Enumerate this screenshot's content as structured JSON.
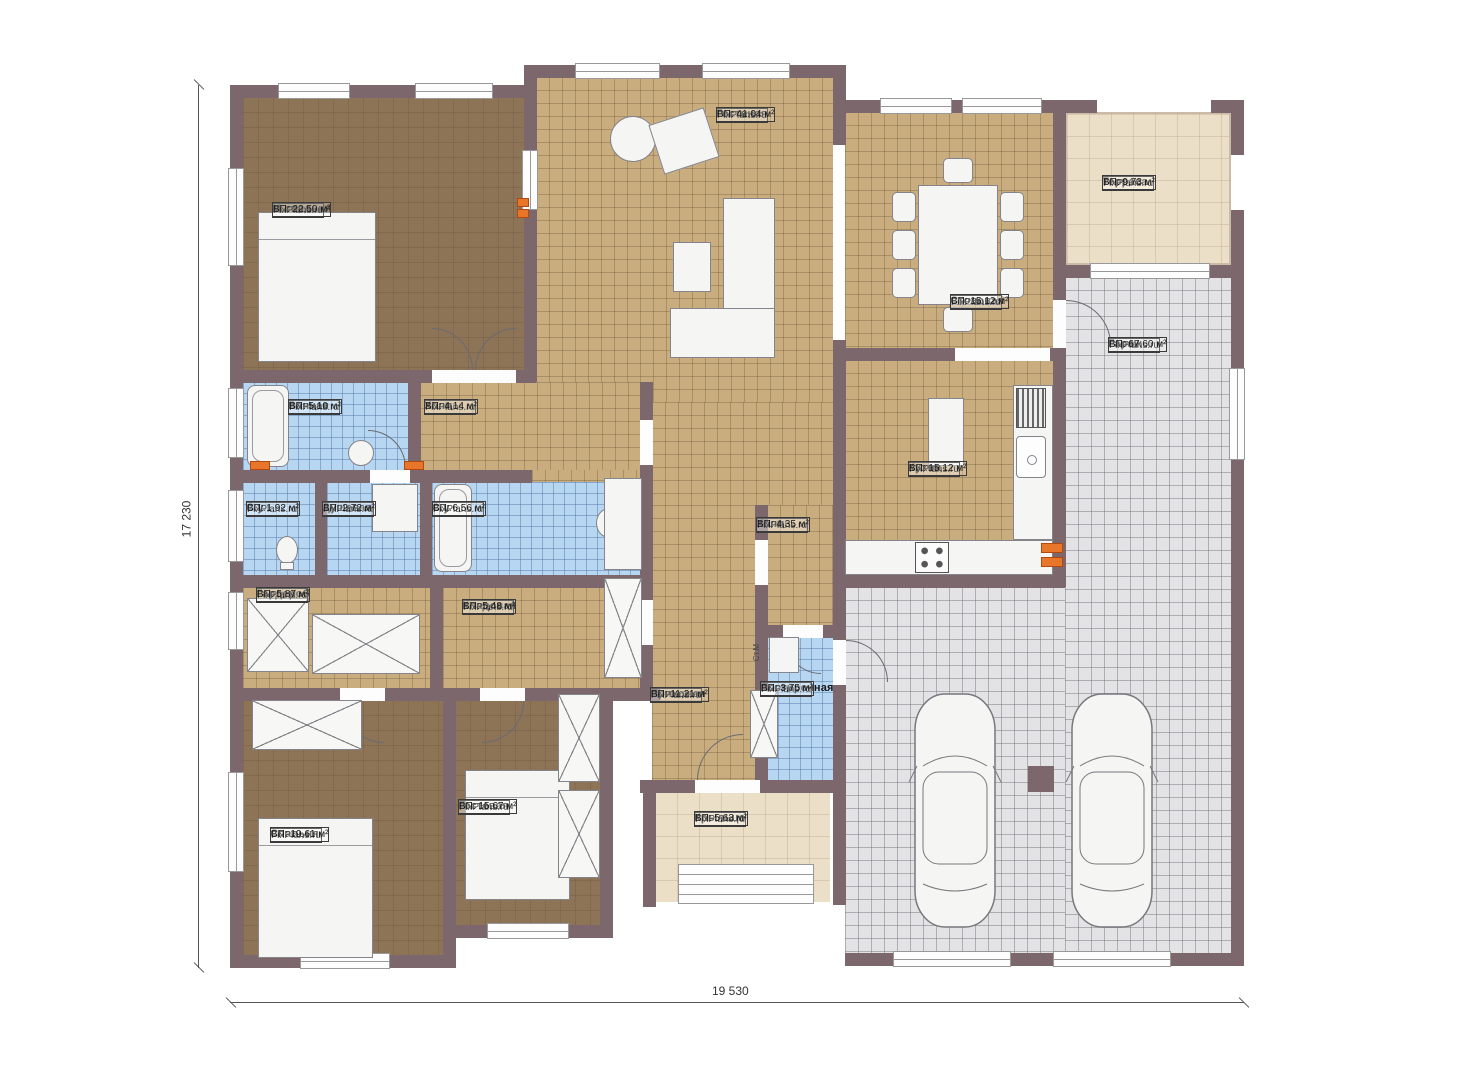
{
  "plan": {
    "brand": "FixPlans.ru",
    "dimensions": {
      "height_label": "17 230",
      "width_label": "19 530"
    },
    "rooms": [
      {
        "name": "Гостиная",
        "area": "ВП: 41,04 м²"
      },
      {
        "name": "М.спальня",
        "area": "ВП: 22,50 м²"
      },
      {
        "name": "Терраса",
        "area": "ВП: 9,73 м²"
      },
      {
        "name": "Столовая",
        "area": "ВП: 15,12 м²"
      },
      {
        "name": "Гараж",
        "area": "ВП: 67,60 м²"
      },
      {
        "name": "Ванная",
        "area": "ВП: 5,10 м²"
      },
      {
        "name": "Холл",
        "area": "ВП: 4,14 м²"
      },
      {
        "name": "С.у.",
        "area": "ВП: 1,92 м²"
      },
      {
        "name": "Душевая",
        "area": "ВП: 2,72 м²"
      },
      {
        "name": "С.у.",
        "area": "ВП: 6,56 м²"
      },
      {
        "name": "Кухня",
        "area": "ВП: 15,12 м²"
      },
      {
        "name": "Холл",
        "area": "ВП: 4,35 м²"
      },
      {
        "name": "Гардероб",
        "area": "ВП: 5,87 м²"
      },
      {
        "name": "Кладовая",
        "area": "ВП: 5,48 м²"
      },
      {
        "name": "Прихожая",
        "area": "ВП: 11,21 м²"
      },
      {
        "name": "Постирочная",
        "area": "ВП: 3,75 м²"
      },
      {
        "name": "Спальня",
        "area": "ВП: 19,61 м²"
      },
      {
        "name": "Гостевая",
        "area": "ВП: 15,67 м²"
      },
      {
        "name": "Крыльцо",
        "area": "ВП: 5,63 м²"
      }
    ],
    "misc": {
      "washer_label": "Ст.М"
    },
    "colors": {
      "wall": "#7c676c",
      "floor_tan": "#c9ad7f",
      "floor_brown": "#8d7457",
      "floor_blue": "#b7d6f2",
      "floor_gray": "#e3e3e5",
      "floor_beige": "#ecdfc7",
      "radiator": "#e8762a"
    }
  }
}
